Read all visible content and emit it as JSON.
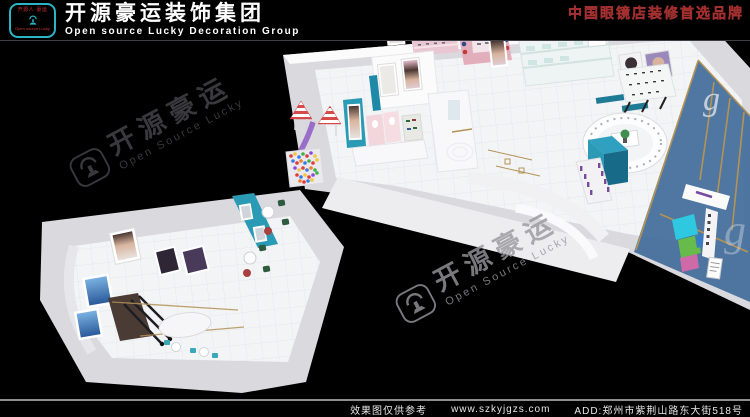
{
  "header": {
    "logo": {
      "top_text": "开源人·豪运",
      "bottom_text": "Open source Lucky"
    },
    "title_cn": "开源豪运装饰集团",
    "title_en": "Open source Lucky Decoration Group",
    "slogan": "中国眼镜店装修首选品牌"
  },
  "watermark": {
    "cn": "开源豪运",
    "en": "Open Source Lucky"
  },
  "scene": {
    "glass_letter": "g"
  },
  "footer": {
    "note": "效果图仅供参考",
    "url": "www.szkyjgzs.com",
    "address": "ADD:郑州市紫荆山路东大街518号"
  },
  "colors": {
    "logo_teal": "#2ab4c4",
    "logo_red": "#d03030",
    "slogan_red": "#8a1d1d",
    "teal_accent": "#2a9ab5",
    "pink_wall": "#e9c6d1",
    "glass_blue": "#46709c",
    "gold_trim": "#b39355",
    "mint_case": "#cfe5e1"
  }
}
